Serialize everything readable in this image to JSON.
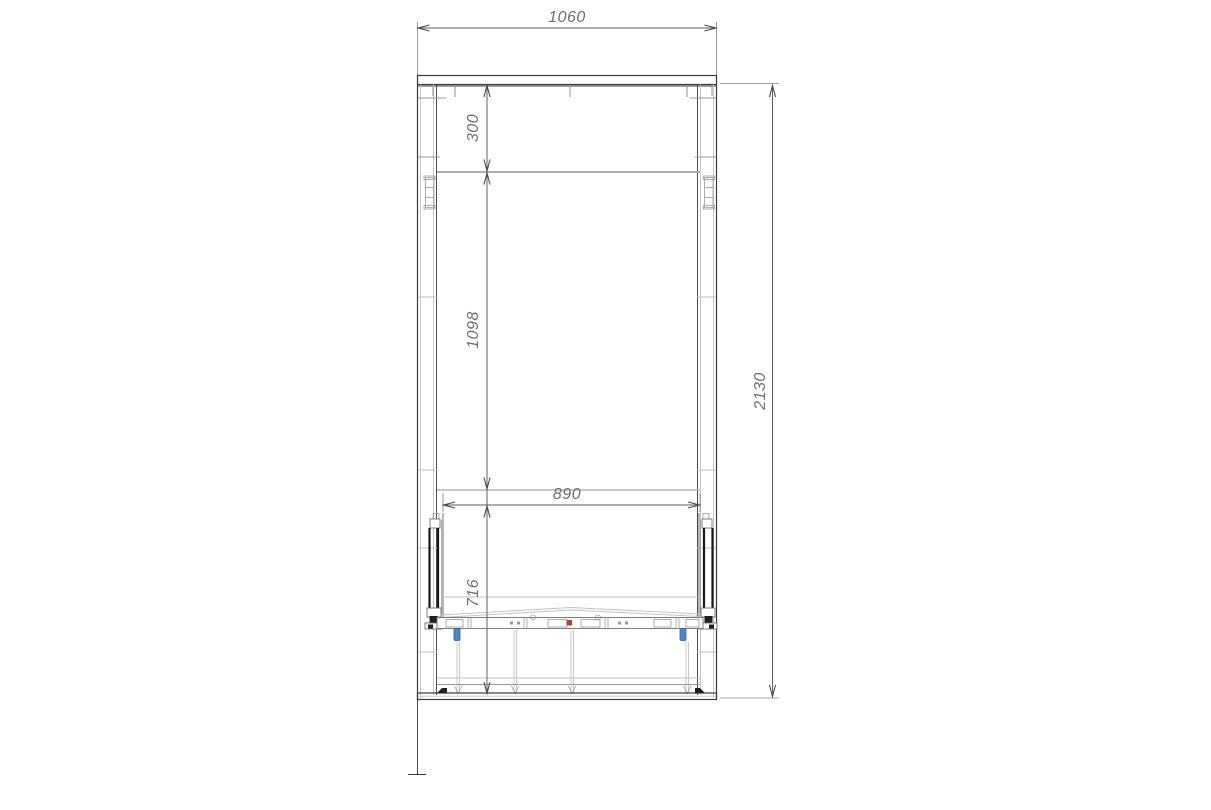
{
  "drawing": {
    "dimensions": {
      "overall_width": "1060",
      "overall_height": "2130",
      "top_offset": "300",
      "opening_height": "1098",
      "inner_width": "890",
      "lower_section_height": "716"
    },
    "colors": {
      "background": "#ffffff",
      "line_primary": "#3a3a3a",
      "line_heavy": "#181818",
      "line_secondary": "#9a9a9a",
      "dimension_line": "#5a5a5a",
      "dimension_text": "#6f6f6f",
      "marker_red": "#c0392b",
      "marker_blue": "#4f86c6",
      "marker_blue_border": "#2f5e9e"
    }
  }
}
